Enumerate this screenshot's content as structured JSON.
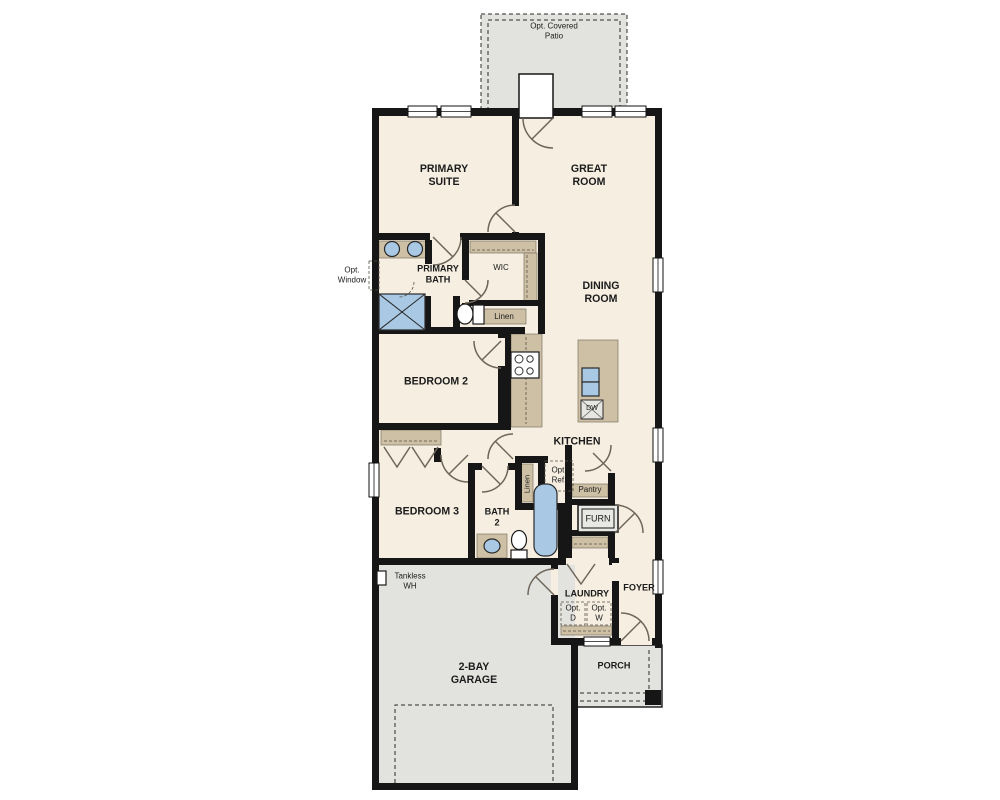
{
  "title": "Single-story floor plan",
  "colors": {
    "wall": "#161616",
    "floor": "#f5eee1",
    "outdoor": "#e2e2df",
    "counter": "#cdc0a5",
    "fixture": "#a9c8e3",
    "door": "#6f665a"
  },
  "labels": {
    "patio": "Opt. Covered\nPatio",
    "primary_suite": "PRIMARY\nSUITE",
    "great_room": "GREAT\nROOM",
    "opt_window": "Opt.\nWindow",
    "primary_bath": "PRIMARY\nBATH",
    "wic": "WIC",
    "linen_upper": "Linen",
    "dining_room": "DINING\nROOM",
    "bedroom_2": "BEDROOM 2",
    "kitchen": "KITCHEN",
    "dw": "DW",
    "linen_lower": "Linen",
    "opt_ref": "Opt.\nRef.",
    "pantry": "Pantry",
    "furn": "FURN",
    "bedroom_3": "BEDROOM 3",
    "bath_2": "BATH\n2",
    "tankless": "Tankless\nWH",
    "laundry": "LAUNDRY",
    "opt_d": "Opt.\nD",
    "opt_w": "Opt.\nW",
    "foyer": "FOYER",
    "porch": "PORCH",
    "garage": "2-BAY\nGARAGE"
  }
}
